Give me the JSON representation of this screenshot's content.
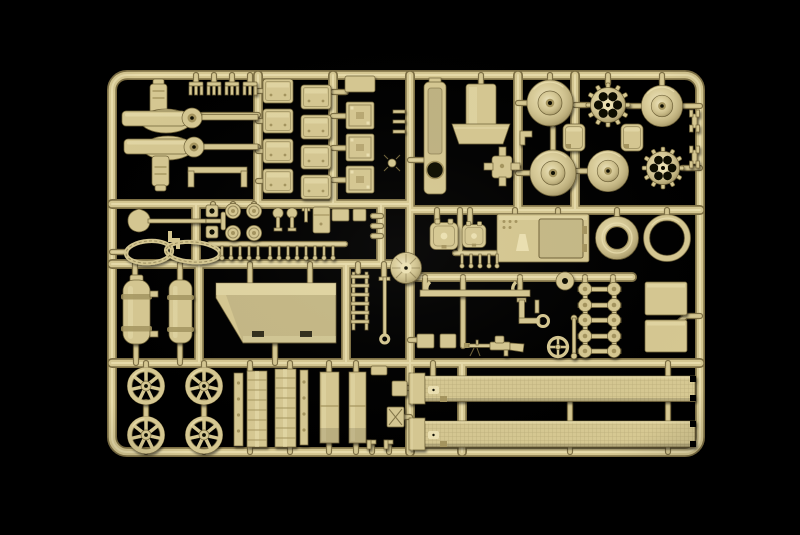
{
  "scene": {
    "description": "Photograph of a tan injection-molded plastic model kit sprue (tank parts) on a black background",
    "palette": {
      "background": "#000000",
      "plastic_base": "#d6c892",
      "plastic_light": "#ece1b2",
      "plastic_dark": "#a5955f",
      "plastic_shadow": "#6f6238"
    },
    "parts_inventory": [
      {
        "name": "road-wheel",
        "count": 4
      },
      {
        "name": "drive-sprocket",
        "count": 2
      },
      {
        "name": "idler-wheel-half",
        "count": 4
      },
      {
        "name": "hub-cap",
        "count": 2
      },
      {
        "name": "stowage-box",
        "count": 8
      },
      {
        "name": "framed-box",
        "count": 3
      },
      {
        "name": "flat-box",
        "count": 1
      },
      {
        "name": "crew-hatch",
        "count": 2
      },
      {
        "name": "engine-deck-panel",
        "count": 1
      },
      {
        "name": "turret-ring",
        "count": 1
      },
      {
        "name": "gasket-ring",
        "count": 1
      },
      {
        "name": "fuel-tank-cylinder",
        "count": 2
      },
      {
        "name": "hull-tub",
        "count": 1
      },
      {
        "name": "track-fender-strip",
        "count": 2
      },
      {
        "name": "leaf-spring-board",
        "count": 2
      },
      {
        "name": "side-strip",
        "count": 2
      },
      {
        "name": "mud-flap",
        "count": 2
      },
      {
        "name": "machine-gun",
        "count": 1
      },
      {
        "name": "shovel",
        "count": 1
      },
      {
        "name": "tow-cable",
        "count": 1
      },
      {
        "name": "exhaust-housing",
        "count": 1
      },
      {
        "name": "wheel-cap-on-ladder",
        "count": 10
      },
      {
        "name": "side-skirt-panel",
        "count": 2
      },
      {
        "name": "track-tool",
        "count": 2
      },
      {
        "name": "comb-clip",
        "count": 4
      },
      {
        "name": "suspension-arm-assembly",
        "count": 2
      },
      {
        "name": "sprue-gate-disc",
        "count": 1
      }
    ]
  }
}
